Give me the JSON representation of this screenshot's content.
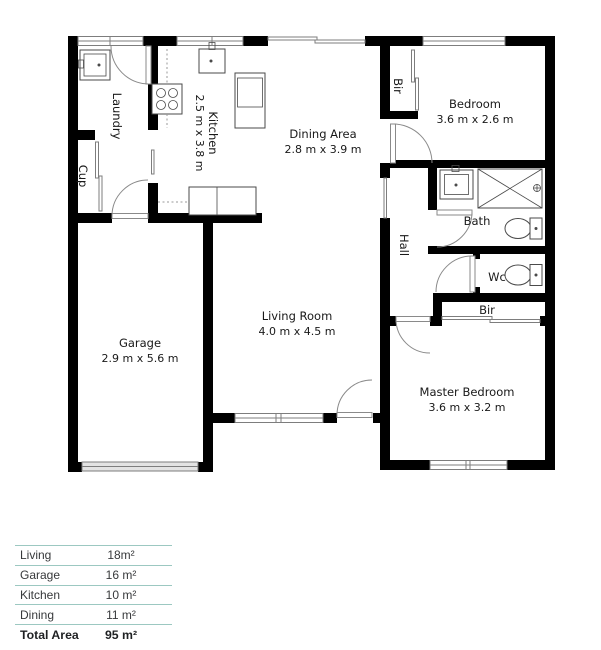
{
  "floor_plan": {
    "rooms": {
      "laundry": {
        "name": "Laundry"
      },
      "cup": {
        "name": "Cup"
      },
      "kitchen": {
        "name": "Kitchen",
        "dims": "2.5 m x 3.8 m"
      },
      "dining": {
        "name": "Dining Area",
        "dims": "2.8 m x 3.9 m"
      },
      "bir_top": {
        "name": "Bir"
      },
      "bedroom": {
        "name": "Bedroom",
        "dims": "3.6 m x 2.6 m"
      },
      "bath": {
        "name": "Bath"
      },
      "hall": {
        "name": "Hall"
      },
      "wc": {
        "name": "Wc"
      },
      "bir_lower": {
        "name": "Bir"
      },
      "master_bedroom": {
        "name": "Master Bedroom",
        "dims": "3.6 m x 3.2 m"
      },
      "living_room": {
        "name": "Living Room",
        "dims": "4.0 m x 4.5 m"
      },
      "garage": {
        "name": "Garage",
        "dims": "2.9 m x 5.6 m"
      }
    }
  },
  "area_table": {
    "rows": [
      {
        "label": "Living",
        "value": "18m²"
      },
      {
        "label": "Garage",
        "value": "16 m²"
      },
      {
        "label": "Kitchen",
        "value": "10 m²"
      },
      {
        "label": "Dining",
        "value": "11 m²"
      }
    ],
    "total": {
      "label": "Total Area",
      "value": "95 m²"
    }
  },
  "colors": {
    "walls": "#000000",
    "table_divider": "#9cc8c1",
    "door_stroke": "#8a8a8a"
  }
}
